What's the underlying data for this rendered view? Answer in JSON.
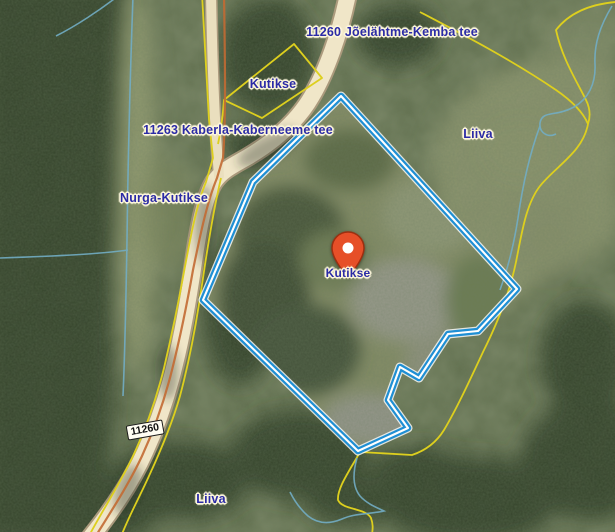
{
  "map": {
    "labels": {
      "road_kemba": "11260 Jõelähtme-Kemba tee",
      "kutikse_top": "Kutikse",
      "road_kaberneeme": "11263 Kaberla-Kaberneeme tee",
      "liiva_right": "Liiva",
      "nurga_kutikse": "Nurga-Kutikse",
      "marker_label": "Kutikse",
      "liiva_bottom": "Liiva",
      "road_shield": "11260"
    },
    "marker": {
      "name": "Kutikse",
      "color": "#e64f28"
    },
    "colors": {
      "parcel_outline": "#1f8fd4",
      "cadastral_line": "#ddcf1e",
      "admin_line": "#c26a33",
      "road_fill": "#f0e6c8",
      "label_text": "#2b2ba6",
      "label_halo": "#fdf7dc",
      "stream": "#72adc4"
    }
  }
}
